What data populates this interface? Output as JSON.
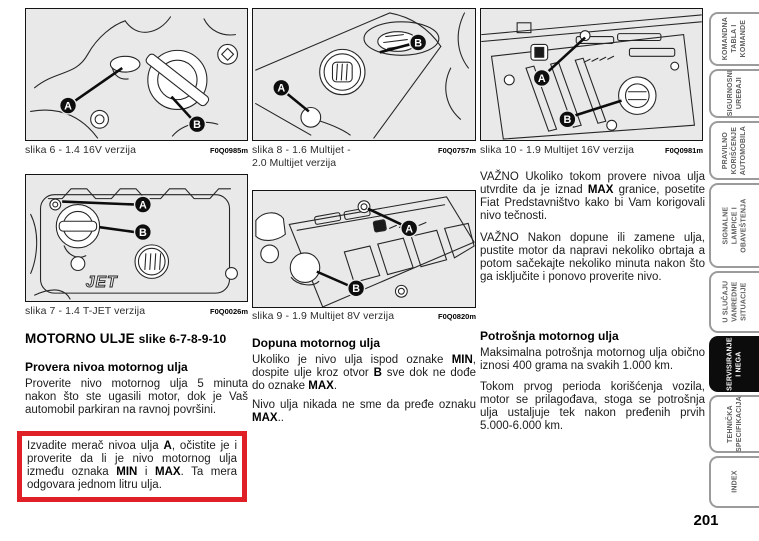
{
  "page": {
    "number": "201"
  },
  "colors": {
    "highlight_red": "#df2127",
    "figure_background": "#e9e9e9",
    "active_tab_background": "#0c0c0c",
    "active_tab_text": "#ffffff",
    "tab_border": "#9b9b9b"
  },
  "figures": [
    {
      "caption": "slika 6 - 1.4 16V verzija",
      "code": "F0Q0985m",
      "markers": {
        "a": "A",
        "b": "B"
      }
    },
    {
      "caption": "slika 7 - 1.4 T-JET verzija",
      "code": "F0Q0026m",
      "cover_label": "JET",
      "markers": {
        "a": "A",
        "b": "B"
      }
    },
    {
      "caption_line1": "slika 8 - 1.6 Multijet -",
      "caption_line2": "2.0 Multijet verzija",
      "code": "F0Q0757m",
      "markers": {
        "a": "A",
        "b": "B"
      }
    },
    {
      "caption": "slika 9 - 1.9 Multijet 8V verzija",
      "code": "F0Q0820m",
      "markers": {
        "a": "A",
        "b": "B"
      }
    },
    {
      "caption": "slika 10 - 1.9 Multijet 16V verzija",
      "code": "F0Q0981m",
      "markers": {
        "a": "A",
        "b": "B"
      }
    }
  ],
  "sections": {
    "motor_oil": {
      "title_main": "MOTORNO ULJE",
      "title_refs": "slike 6-7-8-9-10",
      "check_heading": "Provera nivoa motornog ulja",
      "check_paragraph": "Proverite nivo motornog ulja 5 minuta nakon što ste ugasili motor, dok je Vaš automobil parkiran na ravnoj površini.",
      "highlight_rich": [
        {
          "t": "Izvadite merač nivoa ulja ",
          "b": false
        },
        {
          "t": "A",
          "b": true
        },
        {
          "t": ", očistite je i proverite da li je nivo motornog ulja između oznaka ",
          "b": false
        },
        {
          "t": "MIN",
          "b": true
        },
        {
          "t": " i ",
          "b": false
        },
        {
          "t": "MAX",
          "b": true
        },
        {
          "t": ". Ta mera odgovara jednom litru ulja.",
          "b": false
        }
      ]
    },
    "refill": {
      "heading": "Dopuna motornog ulja",
      "p1_rich": [
        {
          "t": "Ukoliko je nivo ulja ispod oznake ",
          "b": false
        },
        {
          "t": "MIN",
          "b": true
        },
        {
          "t": ", dospite ulje kroz otvor ",
          "b": false
        },
        {
          "t": "B",
          "b": true
        },
        {
          "t": " sve dok ne dođe do oznake ",
          "b": false
        },
        {
          "t": "MAX",
          "b": true
        },
        {
          "t": ".",
          "b": false
        }
      ],
      "p2_rich": [
        {
          "t": "Nivo ulja nikada ne sme da pređe oznaku ",
          "b": false
        },
        {
          "t": "MAX",
          "b": true
        },
        {
          "t": "..",
          "b": false
        }
      ]
    },
    "important": {
      "p1_rich": [
        {
          "t": "VAŽNO Ukoliko tokom provere nivoa ulja utvrdite da je iznad ",
          "b": false
        },
        {
          "t": "MAX",
          "b": true
        },
        {
          "t": " granice, posetite Fiat Predstavništvo kako bi Vam korigovali nivo tečnosti.",
          "b": false
        }
      ],
      "p2": "VAŽNO Nakon dopune ili zamene ulja, pustite motor da napravi nekoliko obrtaja a potom sačekajte nekoliko minuta nakon što ga isključite i ponovo proverite nivo."
    },
    "consumption": {
      "heading": "Potrošnja motornog ulja",
      "p1": "Maksimalna potrošnja motornog ulja obično iznosi 400 grama na svakih 1.000 km.",
      "p2": "Tokom prvog perioda korišćenja vozila, motor se prilagođava, stoga se potrošnja ulja ustaljuje tek nakon pređenih prvih 5.000-6.000 km."
    }
  },
  "sidebar": {
    "tabs": [
      {
        "label": "KOMANDNA\nTABLA I\nKOMANDE",
        "active": false
      },
      {
        "label": "SIGURNOSNI\nUREĐAJI",
        "active": false
      },
      {
        "label": "PRAVILNO\nKORIŠĆENJE\nAUTOMOBILA",
        "active": false
      },
      {
        "label": "SIGNALNE\nLAMPICE I\nOBAVEŠTENJA",
        "active": false
      },
      {
        "label": "U SLUČAJU\nVANREDNE\nSITUACIJE",
        "active": false
      },
      {
        "label": "SERVISIRANJE\nI NEGA",
        "active": true
      },
      {
        "label": "TEHNIČKA\nSPECIFIKACIJA",
        "active": false
      },
      {
        "label": "INDEX",
        "active": false
      }
    ]
  }
}
